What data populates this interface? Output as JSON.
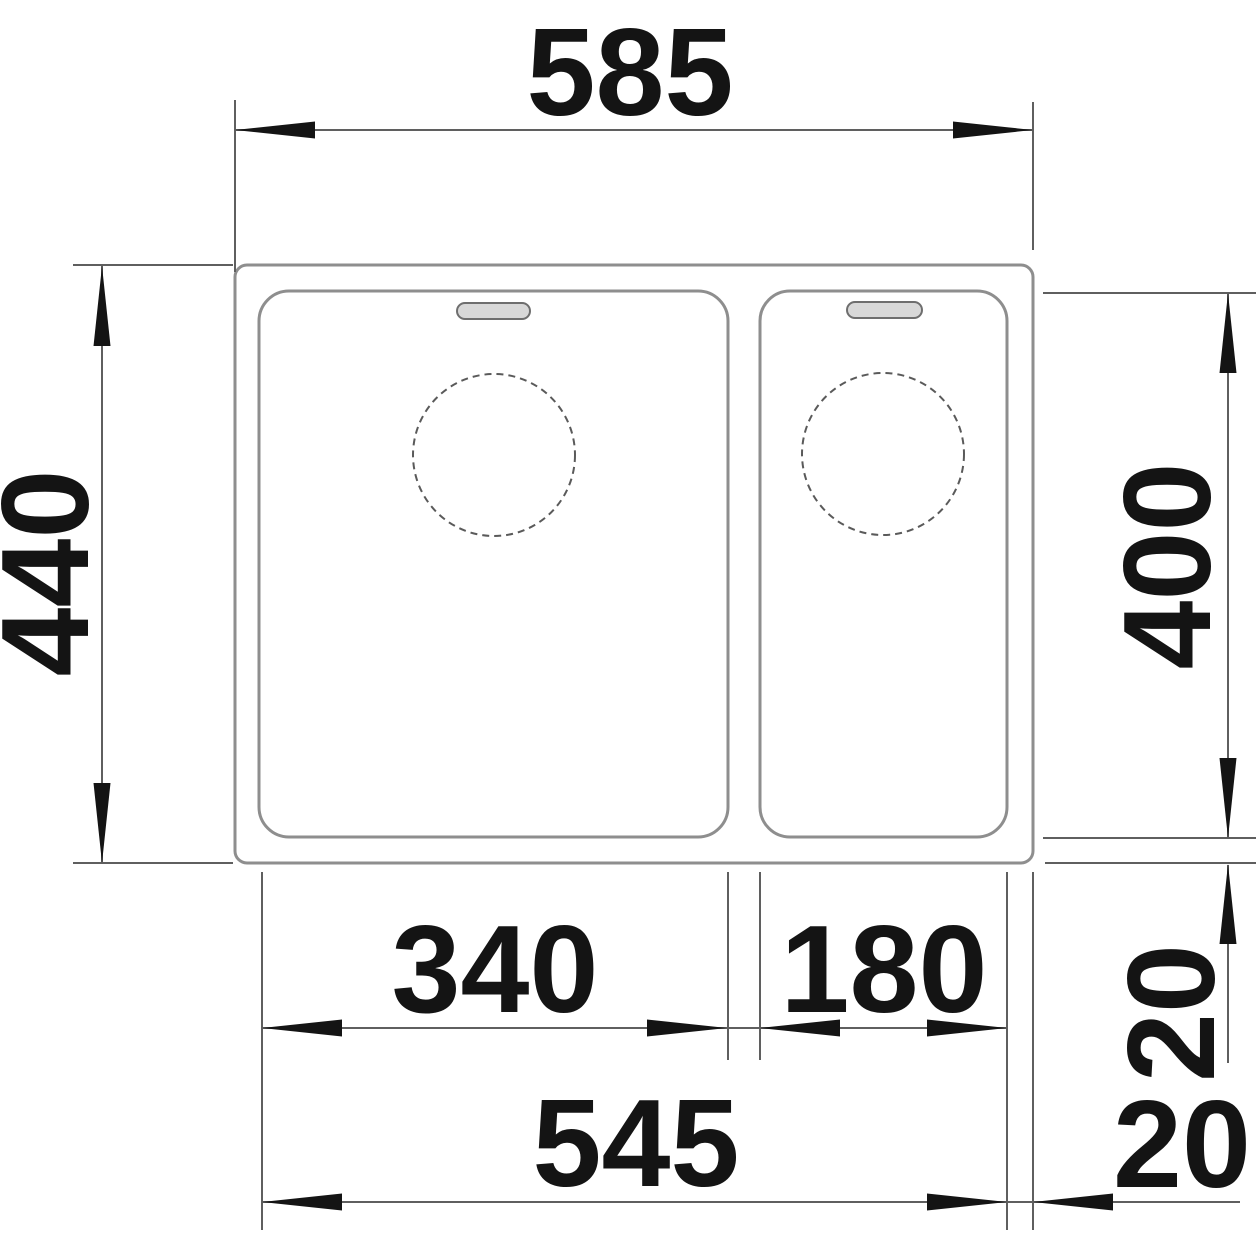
{
  "drawing": {
    "description": "Technical dimension drawing of a kitchen sink with one main bowl and one half bowl, each with a drain hole and an overflow slot",
    "units_hint": "mm",
    "dimensions": {
      "overall_width": "585",
      "overall_depth": "440",
      "bowl_inner_depth": "400",
      "main_bowl_inner_width": "340",
      "half_bowl_inner_width": "180",
      "bowls_combined_width": "545",
      "rim_gap_vertical": "20",
      "rim_gap_horizontal": "20"
    },
    "colors": {
      "background": "#ffffff",
      "sink_outline_gray": "#8e8e8e",
      "dimension_line_gray": "#5f5f5f",
      "ink_black": "#141414",
      "overflow_slot_fill": "#d8d8d8"
    }
  }
}
